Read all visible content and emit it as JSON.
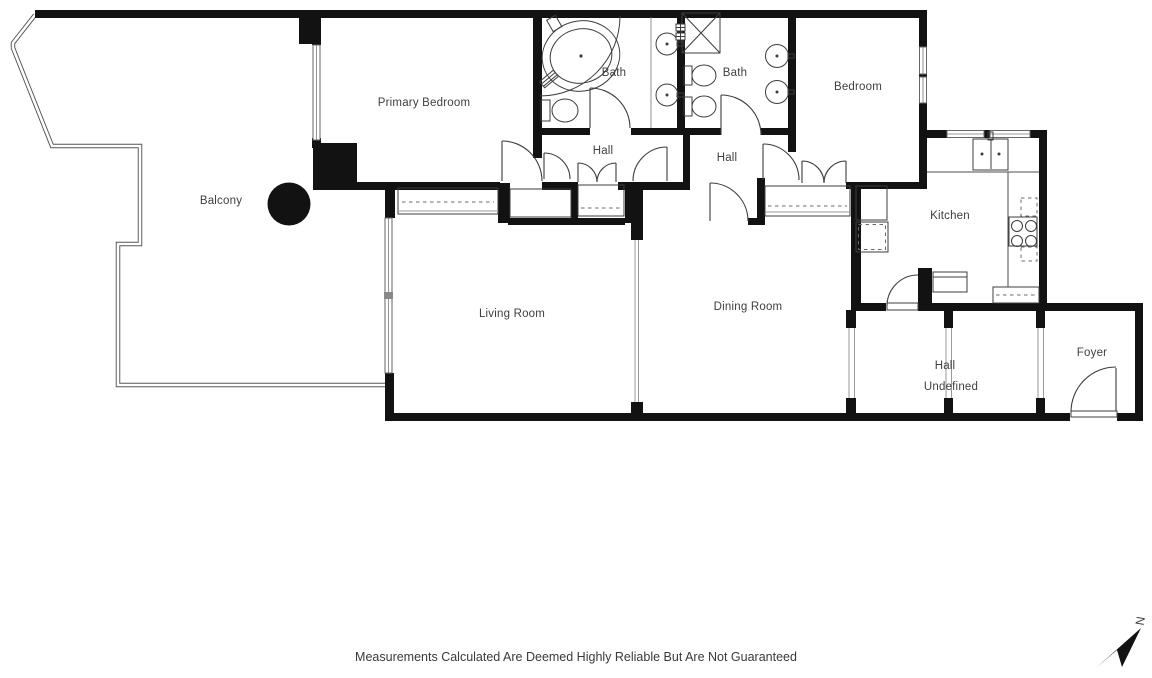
{
  "page": {
    "background": "#ffffff"
  },
  "colors": {
    "wall": "#121212",
    "line": "#4d4d4d",
    "accent": "#111111",
    "text": "#3f3f3f"
  },
  "rooms": {
    "balcony": {
      "label": "Balcony"
    },
    "primary_bedroom": {
      "label": "Primary Bedroom"
    },
    "bath1": {
      "label": "Bath"
    },
    "bath2": {
      "label": "Bath"
    },
    "bedroom": {
      "label": "Bedroom"
    },
    "hall1": {
      "label": "Hall"
    },
    "hall2": {
      "label": "Hall"
    },
    "kitchen": {
      "label": "Kitchen"
    },
    "living_room": {
      "label": "Living Room"
    },
    "dining_room": {
      "label": "Dining Room"
    },
    "hall3": {
      "label": "Hall"
    },
    "undefined_room": {
      "label": "Undefined"
    },
    "foyer": {
      "label": "Foyer"
    }
  },
  "footer": {
    "disclaimer": "Measurements Calculated Are Deemed Highly Reliable But Are Not Guaranteed"
  },
  "compass": {
    "label": "N"
  }
}
